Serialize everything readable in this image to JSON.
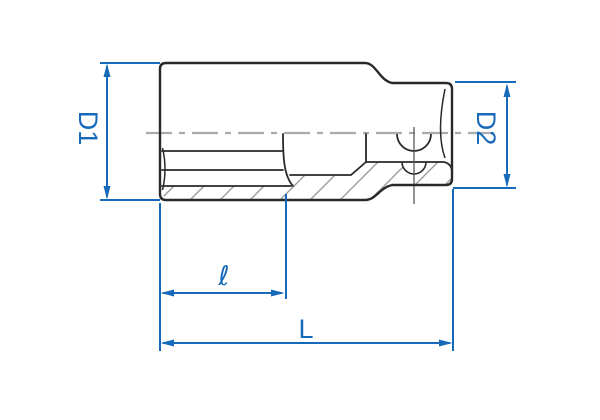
{
  "drawing": {
    "kind": "socket-cross-section-technical-drawing",
    "dimensions": {
      "d1": {
        "label": "D1"
      },
      "d2": {
        "label": "D2"
      },
      "bore_depth": {
        "label": "ℓ"
      },
      "total_length": {
        "label": "L"
      }
    },
    "colors": {
      "dimension_blue": "#1769b9",
      "outline_dark": "#27292b",
      "centerline_gray": "#a9abae",
      "hatch_gray": "#9a9da0",
      "background": "#ffffff"
    }
  }
}
